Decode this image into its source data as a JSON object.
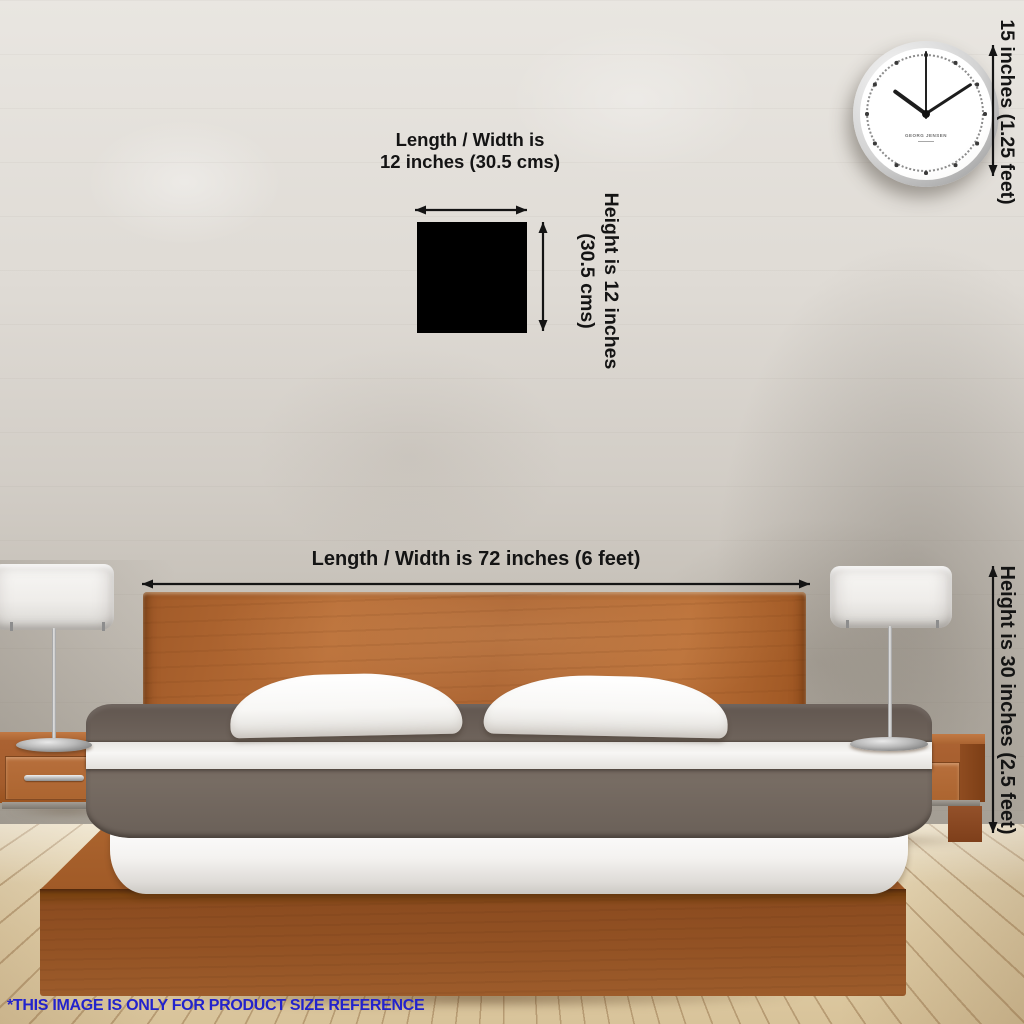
{
  "product_square": {
    "color": "#000000"
  },
  "dimension_labels": {
    "square_width_line1": "Length / Width is",
    "square_width_line2": "12 inches (30.5 cms)",
    "square_height_line1": "Height is 12 inches",
    "square_height_line2": "(30.5 cms)",
    "bed_width": "Length / Width is 72 inches (6 feet)",
    "bed_height": "Height is 30 inches (2.5 feet)",
    "clock_height": "15 inches (1.25 feet)"
  },
  "clock": {
    "brand": "GEORG JENSEN",
    "approx_time_shown": "10:09"
  },
  "footer": {
    "note": "*THIS IMAGE IS ONLY FOR PRODUCT SIZE REFERENCE",
    "color": "#2323cc"
  },
  "palette": {
    "wall_light": "#e9e6e1",
    "wall_dark": "#aca69c",
    "floor_wood": "#e9d7b3",
    "furniture_wood": "#a96230",
    "platform_wood": "#935224",
    "duvet_gray": "#6e635b",
    "lamp_shade": "#efedea",
    "annotation_text": "#141414",
    "footer_blue": "#2323cc"
  }
}
